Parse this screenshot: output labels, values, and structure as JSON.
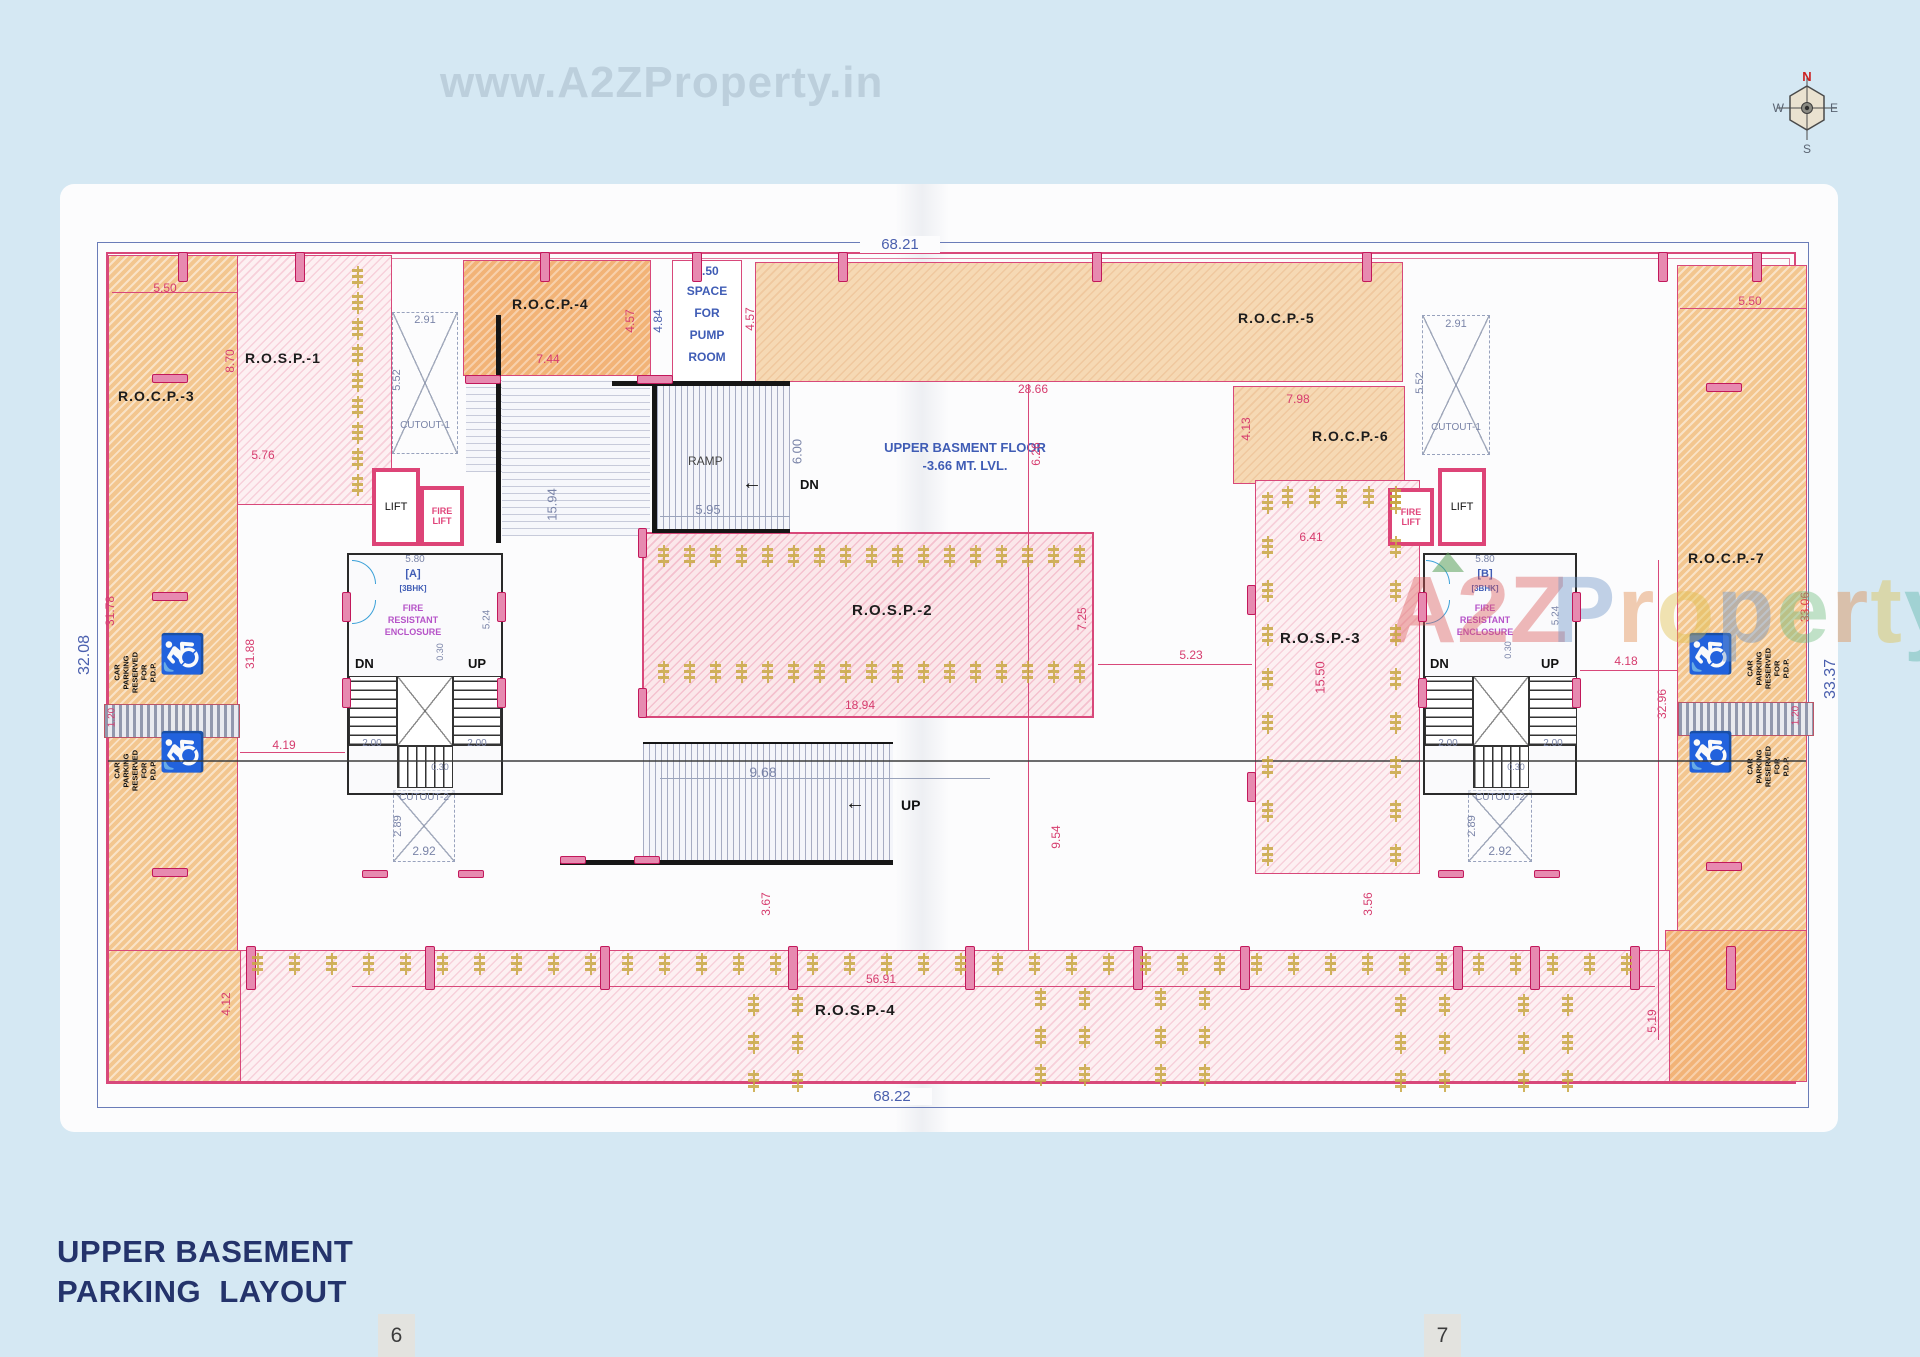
{
  "page": {
    "watermark_top": "www.A2ZProperty.in",
    "title_line1": "UPPER BASEMENT",
    "title_line2": "PARKING  LAYOUT",
    "page_left": "6",
    "page_right": "7"
  },
  "compass": {
    "north": "N",
    "south": "S",
    "east": "E",
    "west": "W"
  },
  "watermark_center": {
    "a2z": "A2Z",
    "property": "Property"
  },
  "floor_note": {
    "line1": "UPPER BASMENT FLOOR",
    "line2": "-3.66 MT. LVL."
  },
  "rooms": {
    "rocp3": "R.O.C.P.-3",
    "rosp1": "R.O.S.P.-1",
    "rocp4": "R.O.C.P.-4",
    "rocp5": "R.O.C.P.-5",
    "rocp6": "R.O.C.P.-6",
    "rocp7": "R.O.C.P.-7",
    "rosp2": "R.O.S.P.-2",
    "rosp3": "R.O.S.P.-3",
    "rosp4": "R.O.S.P.-4",
    "lift": "LIFT",
    "fire": "FIRE",
    "ramp": "RAMP",
    "dn": "DN",
    "up": "UP",
    "cutout1": "CUTOUT-1",
    "cutout2": "CUTOUT-2",
    "unit_a": "[A]",
    "unit_b": "[B]",
    "bhk": "[3BHK]",
    "pump1": "3.50",
    "pump2": "SPACE",
    "pump3": "FOR",
    "pump4": "PUMP",
    "pump5": "ROOM",
    "fre1": "FIRE",
    "fre2": "RESISTANT",
    "fre3": "ENCLOSURE",
    "cp1": "CAR",
    "cp2": "PARKING",
    "cp3": "RESERVED",
    "cp4": "FOR",
    "cp5": "P.D.P.",
    "arrow_left": "←"
  },
  "dims": {
    "d6821": "68.21",
    "d6822": "68.22",
    "d3208": "32.08",
    "d3337": "33.37",
    "d550": "5.50",
    "d870": "8.70",
    "d576": "5.76",
    "d291": "2.91",
    "d552": "5.52",
    "d744": "7.44",
    "d457": "4.57",
    "d484": "4.84",
    "d1594": "15.94",
    "d2866": "28.66",
    "d626": "6.26",
    "d600": "6.00",
    "d595": "5.95",
    "d798": "7.98",
    "d413": "4.13",
    "d641": "6.41",
    "d580": "5.80",
    "d524": "5.24",
    "d030": "0.30",
    "d200": "2.00",
    "d3178": "31.78",
    "d3188": "31.88",
    "d120": "1.20",
    "d419": "4.19",
    "d725": "7.25",
    "d1894": "18.94",
    "d523": "5.23",
    "d1550": "15.50",
    "d968": "9.68",
    "d954": "9.54",
    "d367": "3.67",
    "d356": "3.56",
    "d289": "2.89",
    "d292": "2.92",
    "d5691": "56.91",
    "d412": "4.12",
    "d519": "5.19",
    "d418": "4.18",
    "d3296": "32.96",
    "d3306": "33.06"
  },
  "colors": {
    "accent_pink": "#d8487a",
    "accent_blue": "#4a5fae",
    "orange": "#f2b377",
    "tree": "#c9a843"
  }
}
